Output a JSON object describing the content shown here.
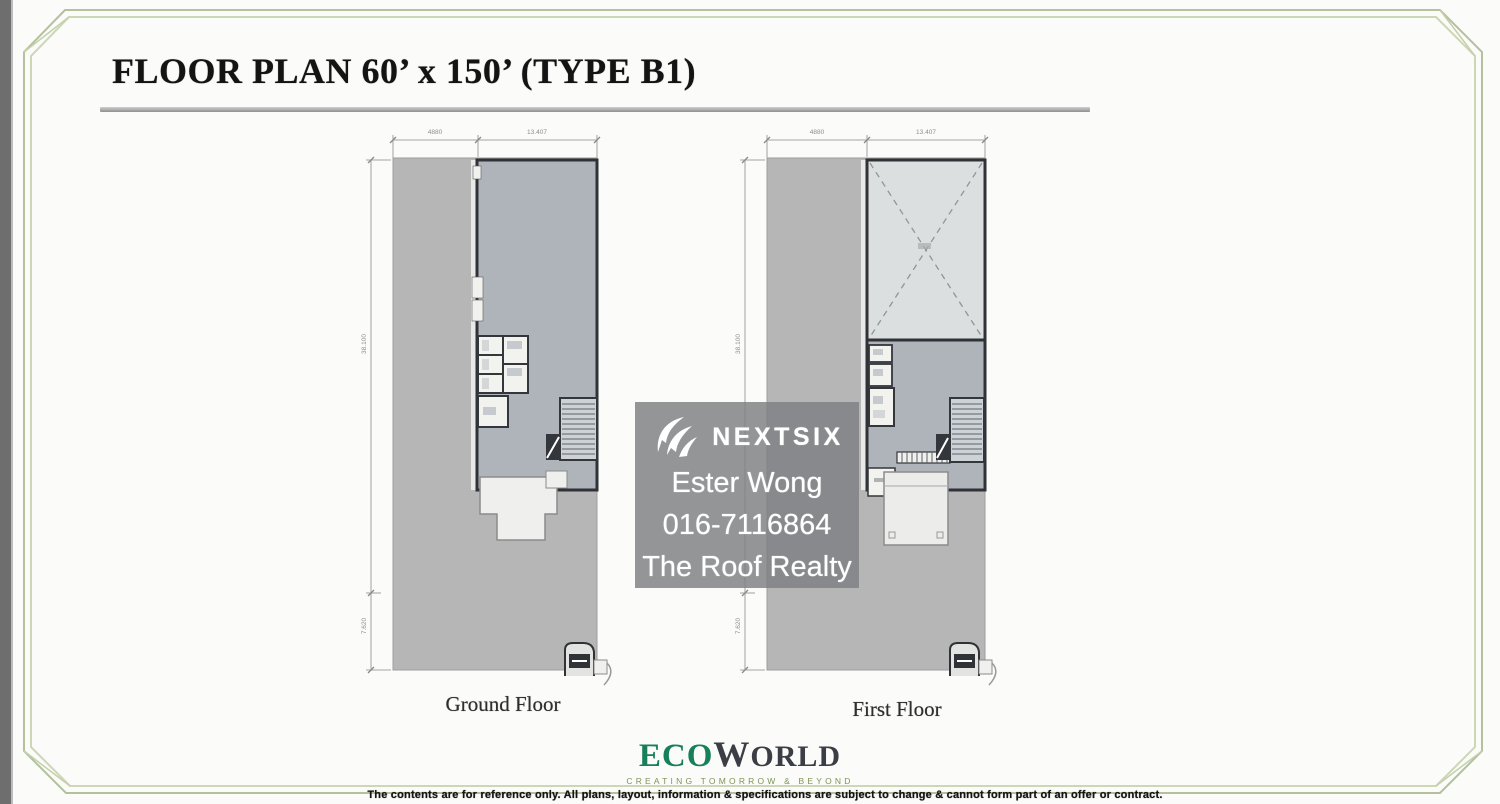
{
  "header": {
    "title": "FLOOR PLAN 60’ x 150’ (TYPE B1)"
  },
  "plans": {
    "ground": {
      "label": "Ground Floor",
      "dim_top_left": "4880",
      "dim_top_right": "13.407",
      "dim_side_main": "38.100",
      "dim_side_lower": "7.620"
    },
    "first": {
      "label": "First Floor",
      "dim_top_left": "4880",
      "dim_top_right": "13.407",
      "dim_side_main": "38.100",
      "dim_side_lower": "7.620"
    }
  },
  "watermark": {
    "brand": "NEXTSIX",
    "agent_name": "Ester Wong",
    "agent_phone": "016-7116864",
    "agency": "The Roof Realty"
  },
  "footer": {
    "brand_eco": "ECO",
    "brand_world": "WORLD",
    "tagline": "CREATING TOMORROW & BEYOND",
    "disclaimer": "The contents are for reference only. All plans, layout, information & specifications are subject to change & cannot form part of an offer or contract."
  },
  "colors": {
    "frame_green": "#b9c7a3",
    "eco_green": "#17805a",
    "lot_gray": "#b6b6b6",
    "building_gray": "#afb4bb",
    "void_room_gray": "#dcdfdf",
    "wall_dark": "#2f3237",
    "watermark_overlay": "rgba(125,128,131,0.83)"
  }
}
